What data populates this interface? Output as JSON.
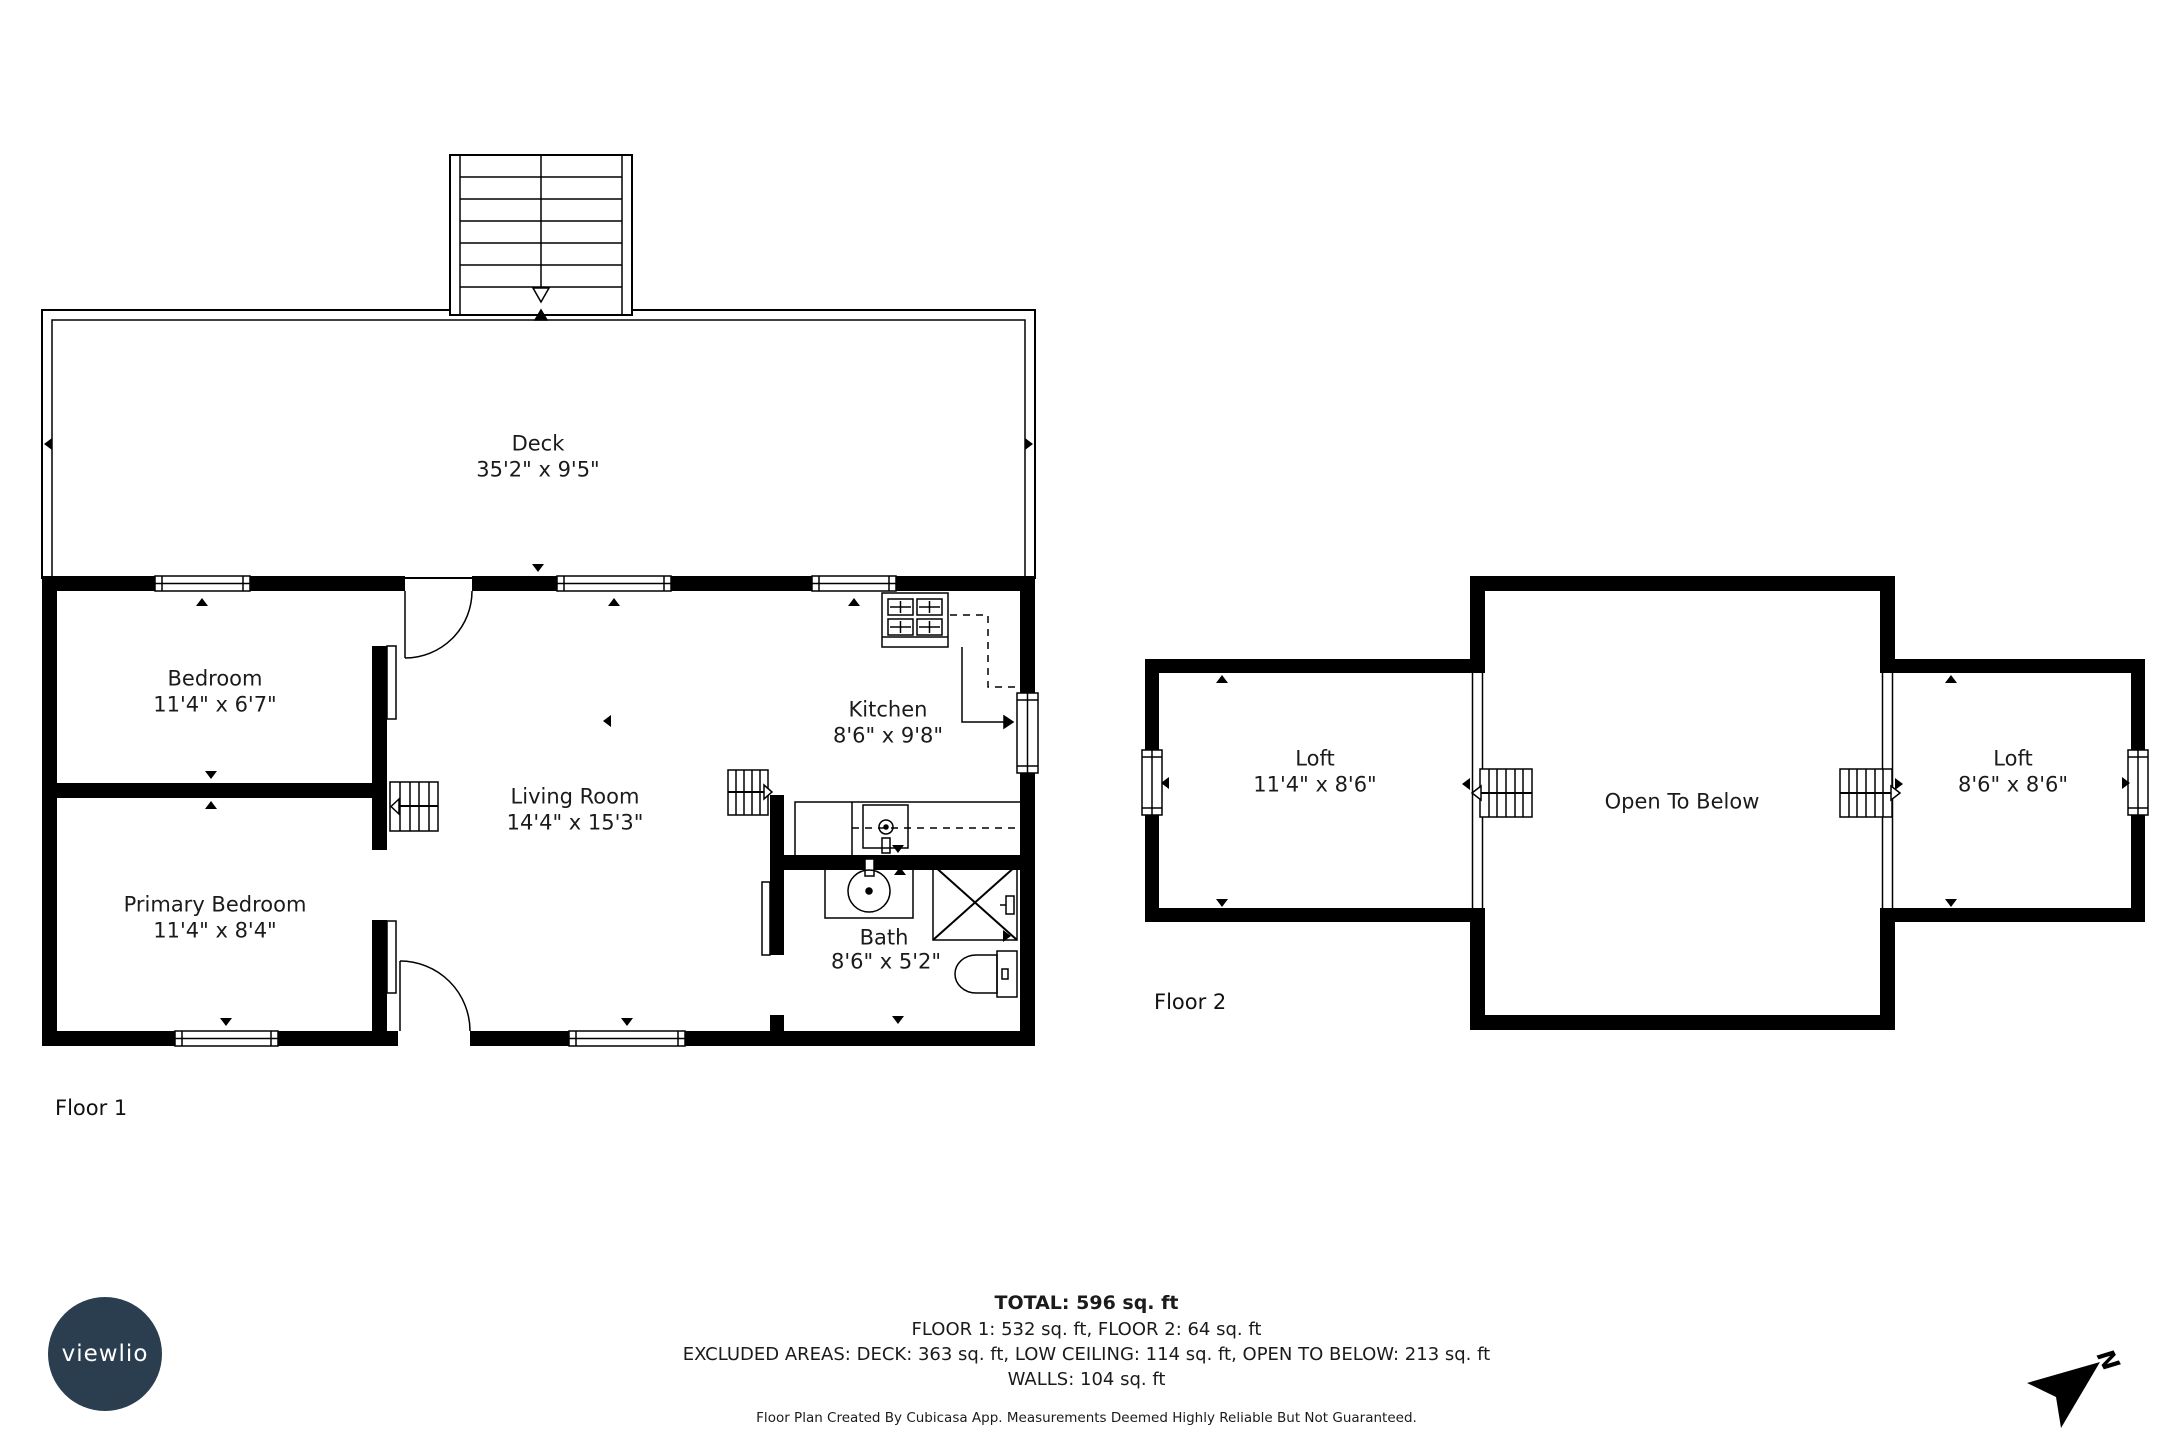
{
  "floor1": {
    "label": "Floor 1",
    "rooms": {
      "deck": {
        "name": "Deck",
        "dims": "35'2\" x 9'5\""
      },
      "bedroom": {
        "name": "Bedroom",
        "dims": "11'4\" x 6'7\""
      },
      "primary_bedroom": {
        "name": "Primary Bedroom",
        "dims": "11'4\" x 8'4\""
      },
      "living_room": {
        "name": "Living Room",
        "dims": "14'4\" x 15'3\""
      },
      "kitchen": {
        "name": "Kitchen",
        "dims": "8'6\" x 9'8\""
      },
      "bath": {
        "name": "Bath",
        "dims": "8'6\" x 5'2\""
      }
    }
  },
  "floor2": {
    "label": "Floor 2",
    "rooms": {
      "loft_left": {
        "name": "Loft",
        "dims": "11'4\" x 8'6\""
      },
      "open_to_below": {
        "name": "Open To Below"
      },
      "loft_right": {
        "name": "Loft",
        "dims": "8'6\" x 8'6\""
      }
    }
  },
  "summary": {
    "total": "TOTAL: 596 sq. ft",
    "floors": "FLOOR 1: 532 sq. ft, FLOOR 2: 64 sq. ft",
    "excluded": "EXCLUDED AREAS: DECK: 363 sq. ft, LOW CEILING: 114 sq. ft, OPEN TO BELOW: 213 sq. ft",
    "walls": "WALLS: 104 sq. ft",
    "disclaimer": "Floor Plan Created By Cubicasa App. Measurements Deemed Highly Reliable But Not Guaranteed."
  },
  "branding": {
    "logo_text": "viewlio",
    "compass_label": "N"
  },
  "colors": {
    "wall": "#000000",
    "background": "#ffffff",
    "logo_bg": "#2b3e4f",
    "text": "#1b1b1b"
  }
}
